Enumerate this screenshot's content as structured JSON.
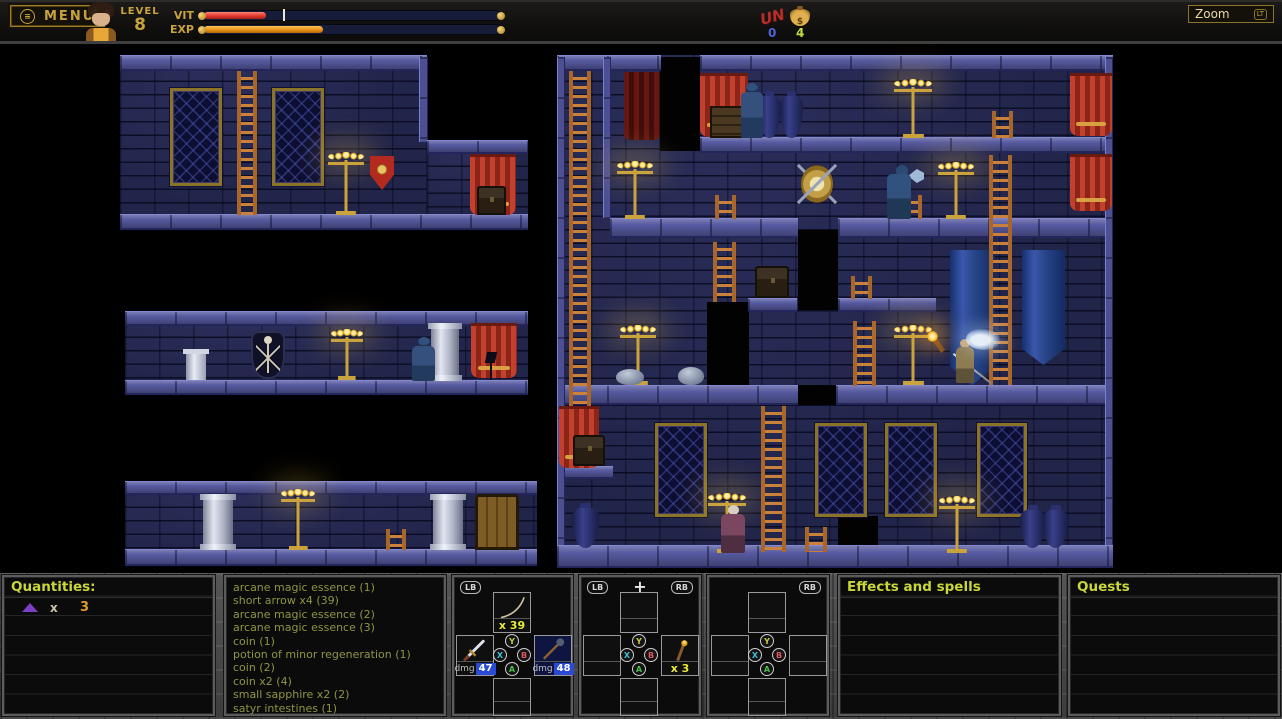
{
  "hud": {
    "menu": {
      "label": "MENU"
    },
    "level": {
      "label": "LEVEL",
      "value": "8"
    },
    "bars": {
      "vit_label": "VIT",
      "exp_label": "EXP",
      "vit_fill_pct": 21,
      "vit_marker_pct": 27,
      "exp_fill_pct": 40
    },
    "currency": {
      "un_label": "UN",
      "un_count": "0",
      "bag_symbol": "$",
      "gold_count": "4"
    },
    "zoom": {
      "label": "Zoom",
      "button_glyph": "LT"
    }
  },
  "panels": {
    "quantities": {
      "header": "Quantities:",
      "row": {
        "times_label": "x",
        "count": "3"
      }
    },
    "loot_log": {
      "items": [
        "arcane magic essence (1)",
        "short arrow x4 (39)",
        "arcane magic essence (2)",
        "arcane magic essence (3)",
        "coin (1)",
        "potion of minor regeneration (1)",
        "coin (2)",
        "coin x2 (4)",
        "small sapphire x2 (2)",
        "satyr intestines (1)"
      ]
    },
    "gamepad_buttons": {
      "y": "Y",
      "x": "X",
      "b": "B",
      "a": "A"
    },
    "pad_left": {
      "badge_left": "LB",
      "top_count": "x 39",
      "left_dmg_label": "dmg",
      "left_dmg": "47",
      "right_dmg_label": "dmg",
      "right_dmg": "48"
    },
    "pad_mid": {
      "badge_left": "LB",
      "badge_center": "+",
      "badge_right": "RB",
      "right_count": "x 3"
    },
    "pad_right": {
      "badge_right": "RB"
    },
    "effects": {
      "header": "Effects and spells"
    },
    "quests": {
      "header": "Quests"
    }
  }
}
